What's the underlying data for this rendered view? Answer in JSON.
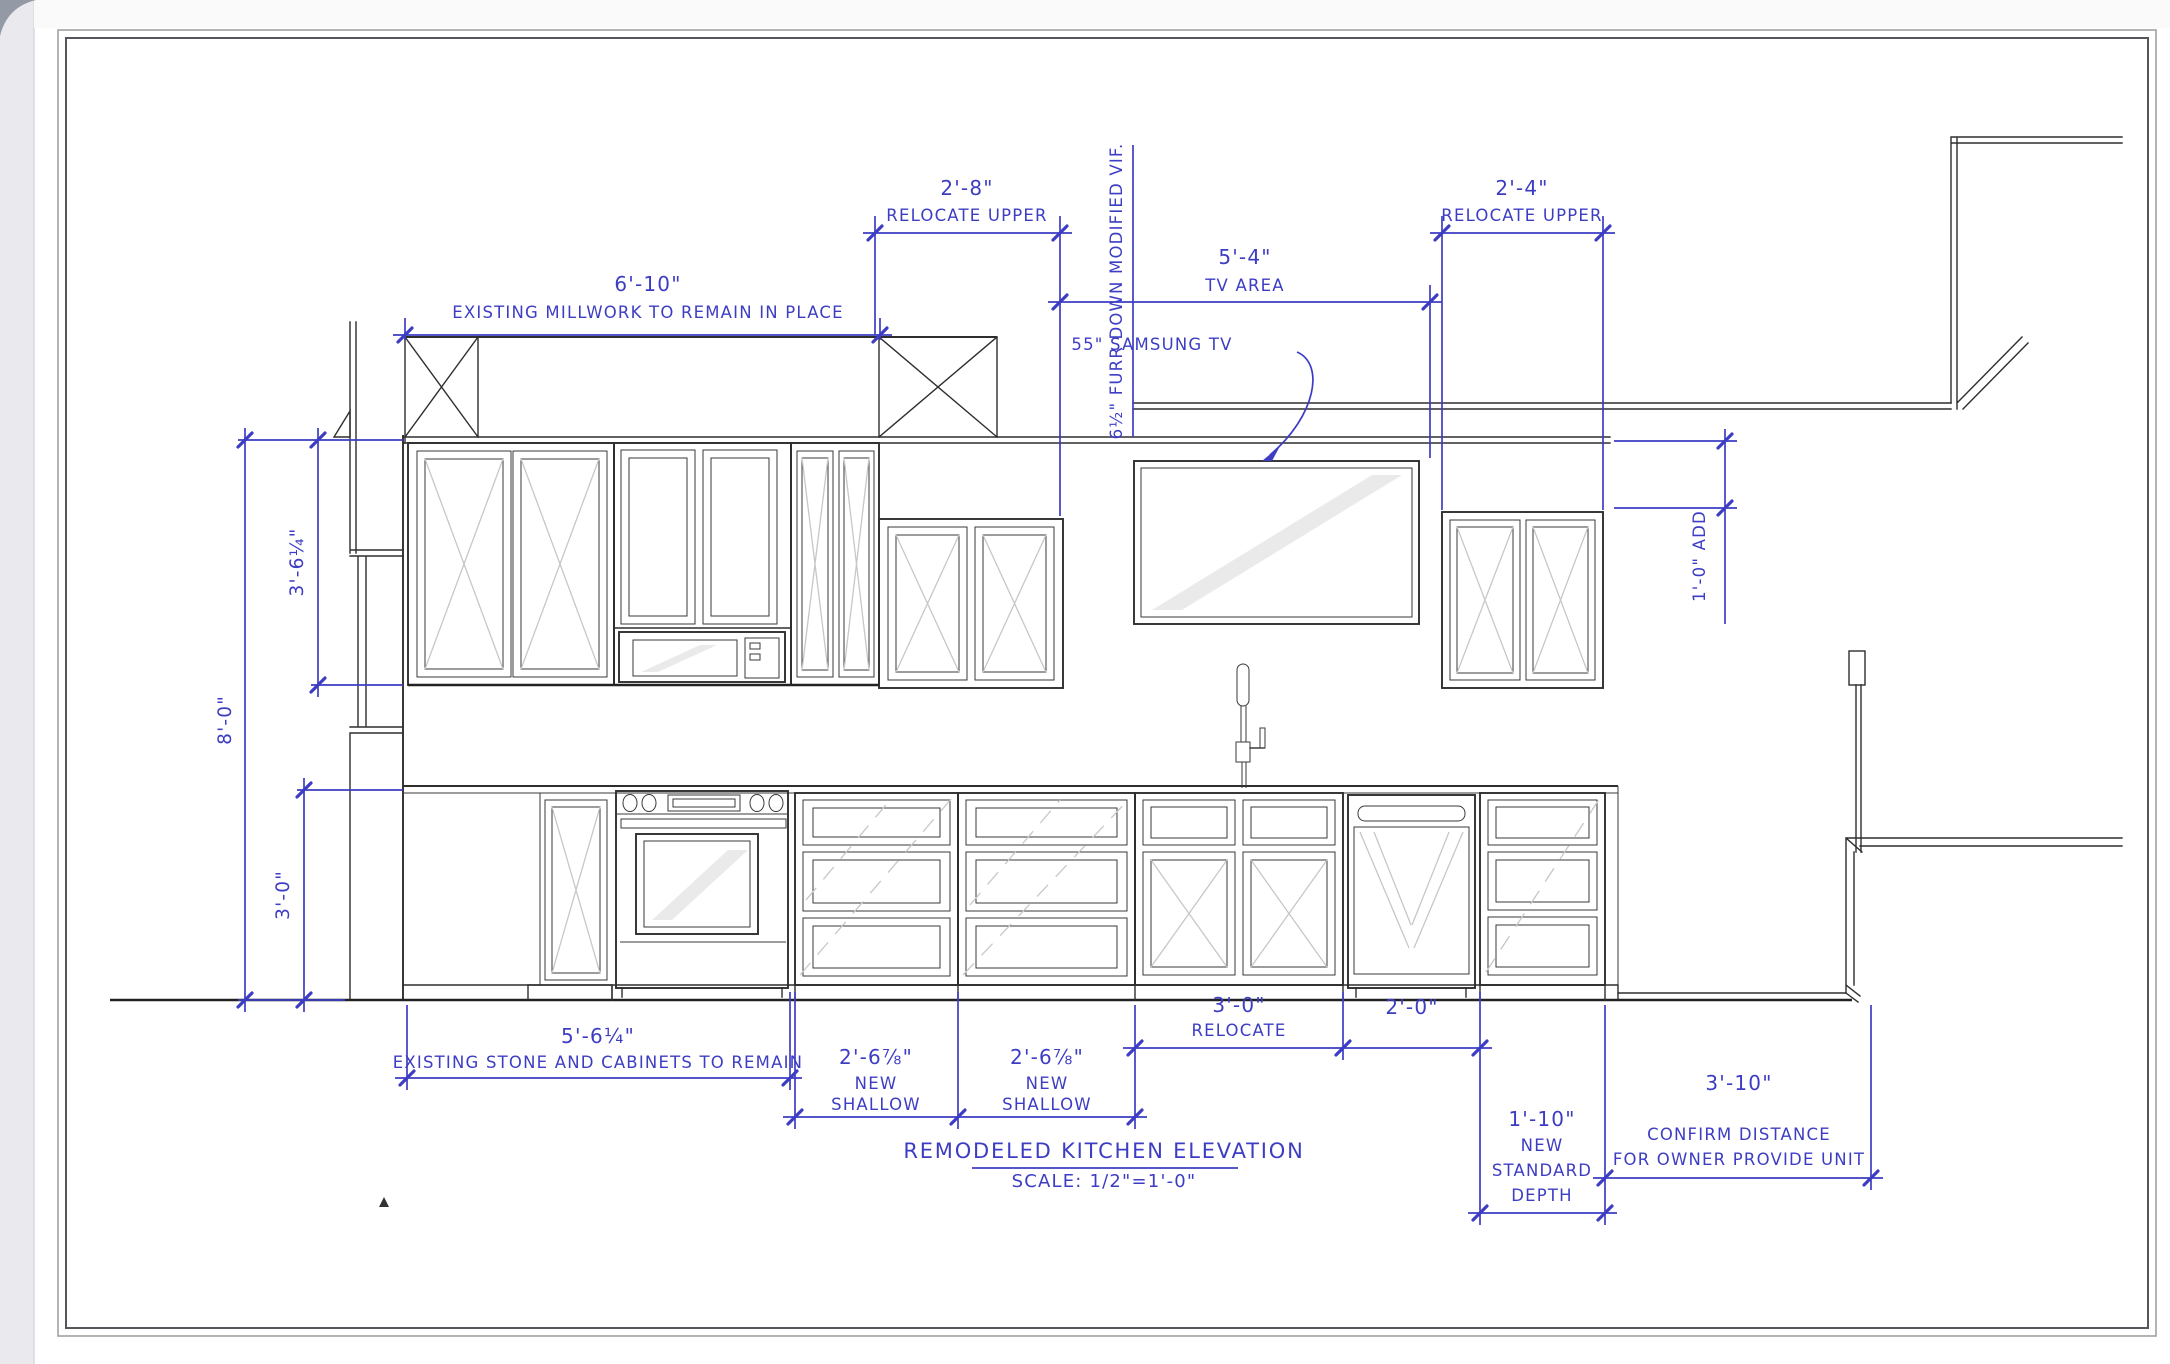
{
  "sheet": {
    "title": "REMODELED KITCHEN ELEVATION",
    "scale_note": "SCALE: 1/2\"=1'-0\"",
    "accent_color": "#3d3dc4"
  },
  "annotations": {
    "millwork": {
      "value": "6'-10\"",
      "label": "EXISTING MILLWORK TO REMAIN IN PLACE"
    },
    "relocate_upper_left": {
      "value": "2'-8\"",
      "label": "RELOCATE UPPER"
    },
    "tv_area": {
      "value": "5'-4\"",
      "label": "TV AREA"
    },
    "relocate_upper_right": {
      "value": "2'-4\"",
      "label": "RELOCATE UPPER"
    },
    "furr_down": {
      "label": "6½\" FURR DOWN MODIFIED VIF."
    },
    "tv_note": {
      "label": "55\" SAMSUNG TV"
    },
    "add_upper": {
      "label": "1'-0\" ADD"
    },
    "ceiling_height": {
      "value": "8'-0\""
    },
    "upper_cab_height": {
      "value": "3'-6¼\""
    },
    "base_height": {
      "value": "3'-0\""
    },
    "existing_base": {
      "value": "5'-6¼\"",
      "label": "EXISTING STONE AND CABINETS TO REMAIN"
    },
    "new_shallow_left": {
      "value": "2'-6⅞\"",
      "line2": "NEW",
      "line3": "SHALLOW"
    },
    "new_shallow_right": {
      "value": "2'-6⅞\"",
      "line2": "NEW",
      "line3": "SHALLOW"
    },
    "sink_relocate": {
      "value": "3'-0\"",
      "label": "RELOCATE"
    },
    "dishwasher_width": {
      "value": "2'-0\""
    },
    "standard_depth": {
      "value": "1'-10\"",
      "line2": "NEW",
      "line3": "STANDARD",
      "line4": "DEPTH"
    },
    "owner_unit": {
      "value": "3'-10\"",
      "line2": "CONFIRM DISTANCE",
      "line3": "FOR OWNER PROVIDE UNIT"
    }
  }
}
